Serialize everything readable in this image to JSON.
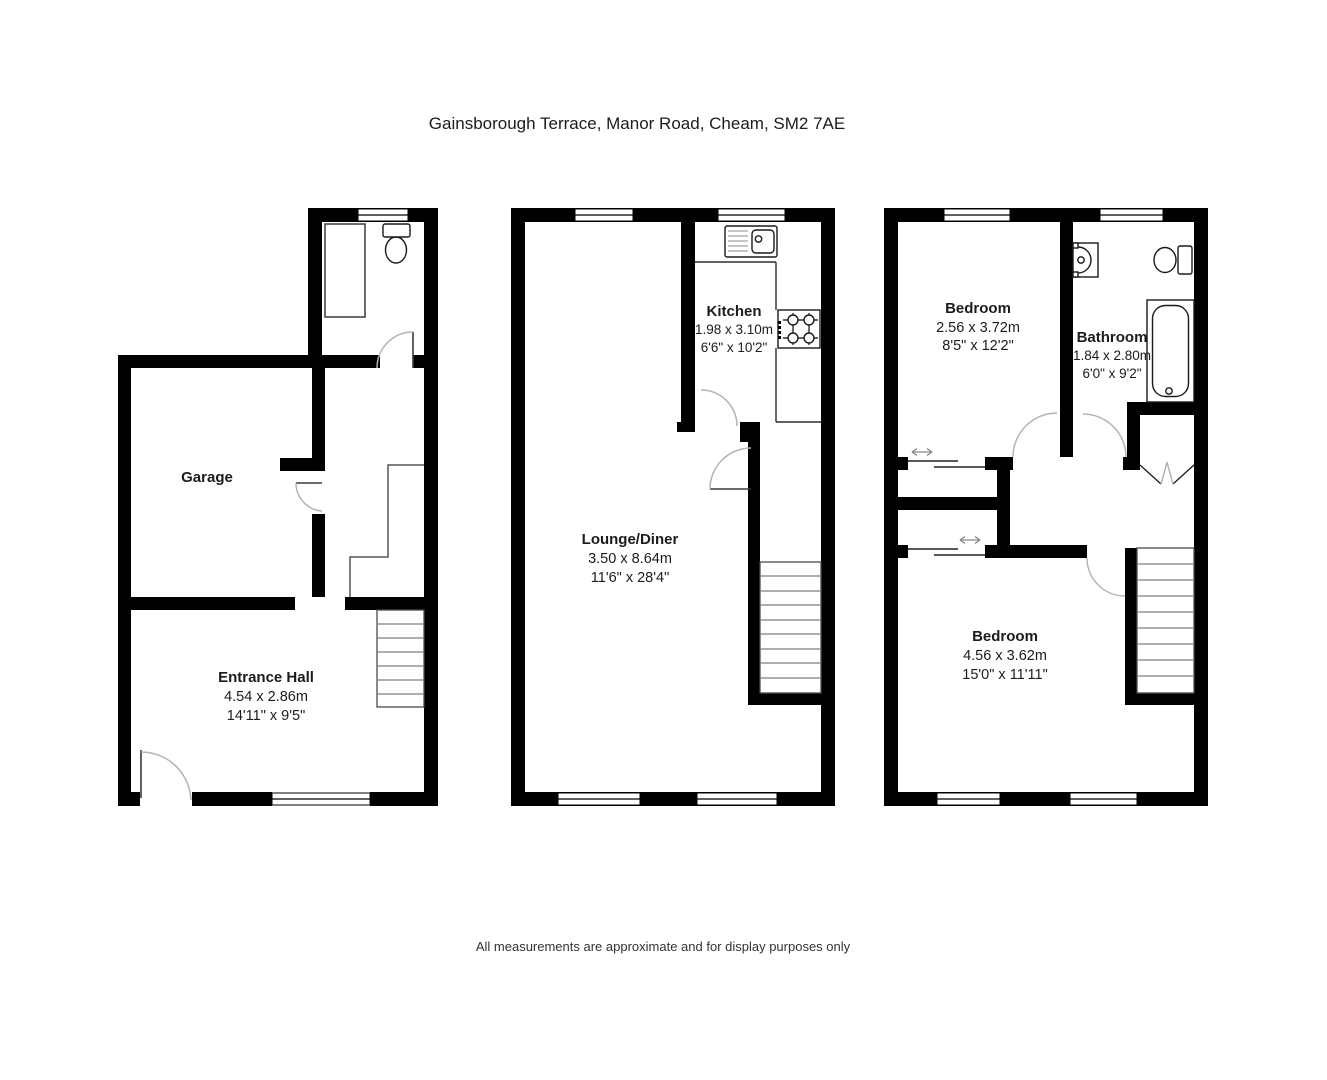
{
  "title": "Gainsborough Terrace, Manor Road, Cheam, SM2 7AE",
  "disclaimer": "All measurements are approximate and for display purposes only",
  "floors": {
    "ground": {
      "rooms": {
        "garage": {
          "name": "Garage"
        },
        "entrance_hall": {
          "name": "Entrance Hall",
          "metric": "4.54 x 2.86m",
          "imperial": "14'11\" x 9'5\""
        }
      },
      "fixtures": [
        "toilet",
        "stairs",
        "front-door",
        "window"
      ]
    },
    "first": {
      "rooms": {
        "kitchen": {
          "name": "Kitchen",
          "metric": "1.98 x 3.10m",
          "imperial": "6'6\" x 10'2\""
        },
        "lounge_diner": {
          "name": "Lounge/Diner",
          "metric": "3.50 x 8.64m",
          "imperial": "11'6\" x 28'4\""
        }
      },
      "fixtures": [
        "sink-drainer",
        "hob",
        "worktop",
        "stairs"
      ]
    },
    "second": {
      "rooms": {
        "bedroom_front": {
          "name": "Bedroom",
          "metric": "2.56 x 3.72m",
          "imperial": "8'5\" x 12'2\""
        },
        "bathroom": {
          "name": "Bathroom",
          "metric": "1.84 x 2.80m",
          "imperial": "6'0\" x 9'2\""
        },
        "bedroom_back": {
          "name": "Bedroom",
          "metric": "4.56 x 3.62m",
          "imperial": "15'0\" x 11'11\""
        }
      },
      "fixtures": [
        "basin",
        "toilet",
        "bath",
        "sliding-wardrobe-doors",
        "cupboard-bifold-doors",
        "stairs"
      ]
    }
  },
  "colors": {
    "wall": "#000000",
    "door_arc": "#b3b3b3",
    "stair_tread": "#7d7d7d",
    "background": "#ffffff"
  }
}
